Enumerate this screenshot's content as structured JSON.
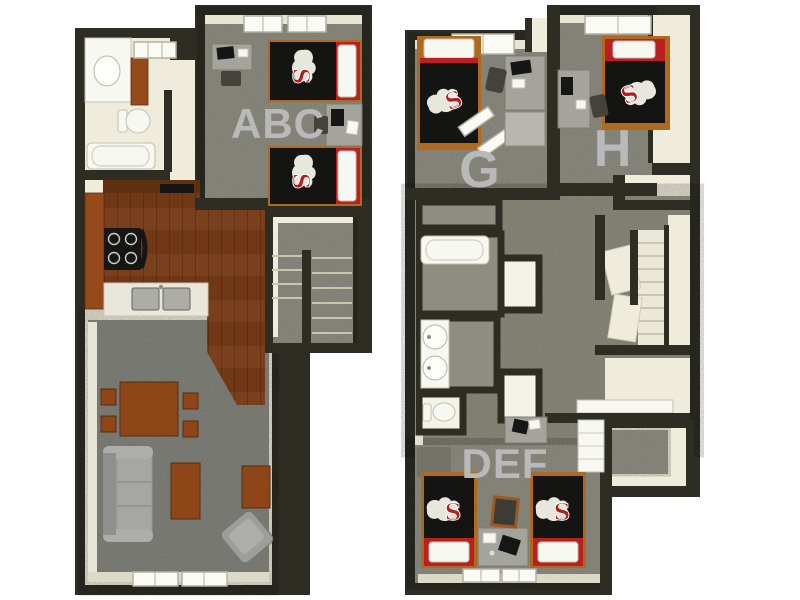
{
  "image": {
    "kind": "3d-rendered apartment floor plan, top-down view",
    "units": 2
  },
  "colors": {
    "wall": "#2d2d24",
    "carpet": "#8d8d82",
    "carpet_dark": "#82827c",
    "carpet_hall": "#8b8b7c",
    "cream": "#efecdc",
    "white_fixture": "#f8f8f2",
    "wood_floor": "#7a3f1c",
    "wood_cabinet": "#96491a",
    "wood_dark": "#5e3010",
    "wood_furniture": "#8e4517",
    "bed_frame": "#b06a20",
    "appliance_black": "#161614",
    "bedding_black": "#141412",
    "accent_red": "#bb1f1f",
    "metal_gray": "#adada5",
    "sofa_gray": "#9d9d9b",
    "desk_gray": "#a4a49c",
    "label_gray": "#b9b9b9",
    "logo_red": "#b41d1d",
    "logo_white": "#f2f2ea"
  },
  "floorplans": [
    {
      "id": "first-floor",
      "position": "left",
      "rooms": [
        {
          "id": "bedroom-abc",
          "label": "ABC"
        },
        {
          "id": "bathroom"
        },
        {
          "id": "kitchen"
        },
        {
          "id": "dining-living-room"
        },
        {
          "id": "stairs"
        }
      ]
    },
    {
      "id": "second-floor",
      "position": "right",
      "rooms": [
        {
          "id": "bedroom-g",
          "label": "G"
        },
        {
          "id": "bedroom-h",
          "label": "H"
        },
        {
          "id": "bedroom-def",
          "label": "DEF"
        },
        {
          "id": "bath-suite"
        },
        {
          "id": "stairs"
        },
        {
          "id": "storage"
        }
      ]
    }
  ]
}
